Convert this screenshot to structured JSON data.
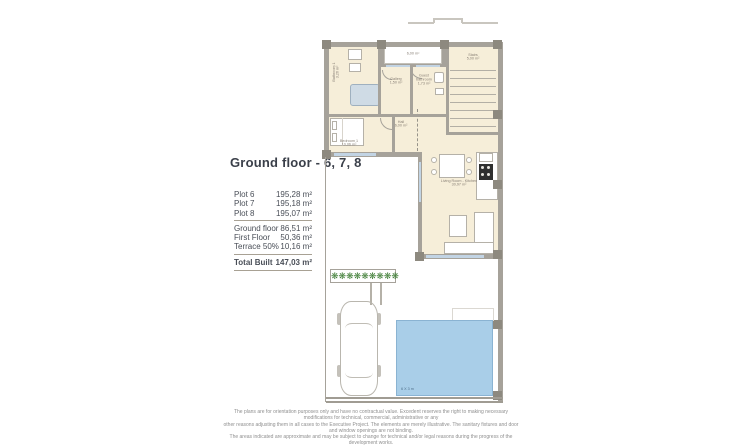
{
  "title": "Ground floor - 6, 7, 8",
  "table": {
    "plots": [
      {
        "label": "Plot 6",
        "value": "195,28 m²"
      },
      {
        "label": "Plot 7",
        "value": "195,18 m²"
      },
      {
        "label": "Plot 8",
        "value": "195,07 m²"
      }
    ],
    "areas": [
      {
        "label": "Ground floor",
        "value": "86,51 m²"
      },
      {
        "label": "First Floor",
        "value": "50,36 m²"
      },
      {
        "label": "Terrace 50%",
        "value": "10,16 m²"
      }
    ],
    "total": {
      "label": "Total Built",
      "value": "147,03 m²"
    }
  },
  "plan": {
    "rooms": {
      "porch_area": "6,00 m²",
      "stairs_name": "Stairs",
      "stairs_area": "5,00 m²",
      "bathroom_name": "Bathroom 1",
      "bathroom_area": "3,26 m²",
      "gallery_name": "Gallery",
      "gallery_area": "1,50 m²",
      "guest_name": "Guest",
      "guest_name2": "bathroom",
      "guest_area": "1,73 m²",
      "hall_name": "Hall",
      "hall_area": "6,00 m²",
      "bedroom_name": "Bedroom 1",
      "bedroom_area": "10,06 m²",
      "living_name": "Living Room - Kitchen",
      "living_area": "30,97 m²"
    },
    "pool_label": "6 X 3 m",
    "plant_glyph": "❋"
  },
  "colors": {
    "room_fill": "#f6eed9",
    "wall": "#a6a29a",
    "pillar": "#8d897f",
    "window": "#c2d4e4",
    "pool": "#a9cee8",
    "plant": "#3e7d35",
    "title_text": "#3a3f49"
  },
  "disclaimer": {
    "line1": "The plans are for orientation purposes only and have no contractual value. Excedent reserves the right to making necessary modifications for technical, commercial, administrative or any",
    "line2": "other reasons adjusting them in all cases to the Executive Project. The elements are merely illustrative. The sanitary fixtures and door and window openings are not binding.",
    "line3": "The areas indicated are approximate and may be subject to change for technical and/or legal reasons during the progress of the development works."
  }
}
